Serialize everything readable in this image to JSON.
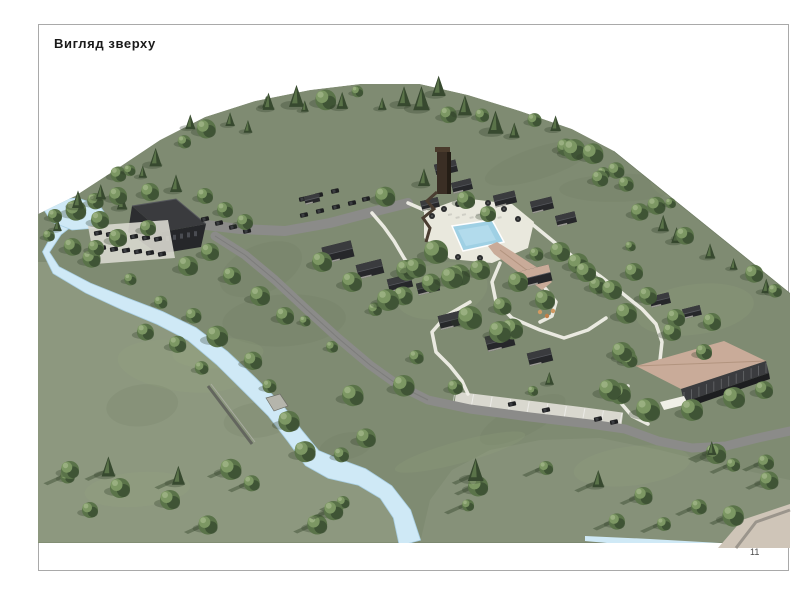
{
  "page": {
    "title": "Вигляд зверху",
    "page_number": "11"
  },
  "render": {
    "name": "aerial-site-render",
    "colors": {
      "frame_border": "#a9a9a9",
      "terrain": "#7f8b72",
      "terrain_light": "#8d987f",
      "terrain_shade": "#68755c",
      "water": "#cfe9f6",
      "water_edge": "#a9cfe3",
      "pool": "#9fd0e4",
      "road": "#8b8b89",
      "road_dark": "#6f6f6d",
      "path": "#f0efe7",
      "parking": "#d9d8cf",
      "building_dark": "#26272a",
      "building_mid": "#3a3b3e",
      "building_light": "#55575c",
      "roof_tan": "#c9ab99",
      "roof_tan_dark": "#b2947f",
      "tower_brown": "#3a2e24",
      "tree_dark": "#37492f",
      "tree_mid": "#5a7349",
      "tree_light": "#7c9763",
      "tree_pale": "#9cb183",
      "car_dark": "#1e1f21",
      "playground_orange": "#d29a62",
      "ramp_tan": "#cfc5b8",
      "text": "#1a1a1a",
      "page_number_color": "#4a4a4a"
    }
  }
}
